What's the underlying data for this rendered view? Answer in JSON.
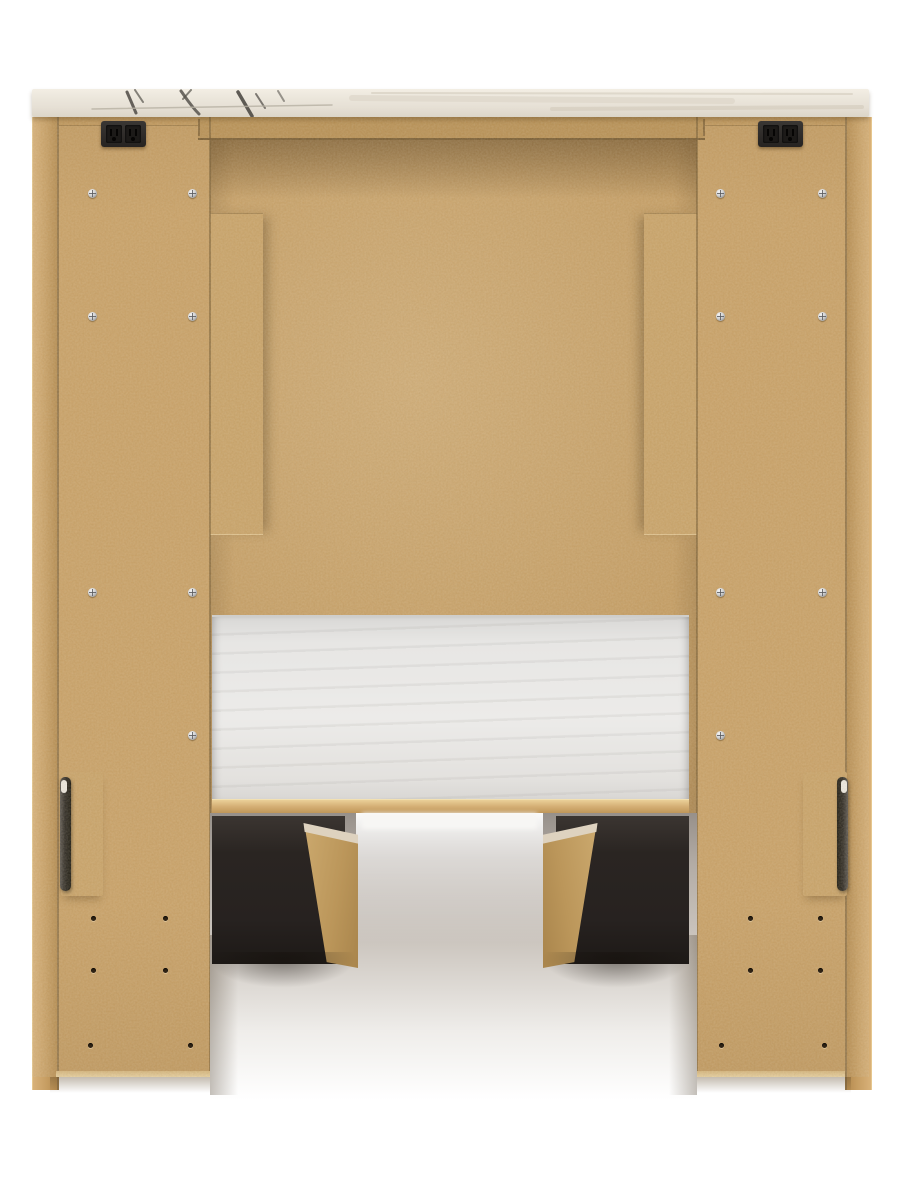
{
  "scene": {
    "description": "Back view product photo of a tan MDF platform bed / headboard unit with marble-look top panel, white fabric mattress deck, two dark under-bed storage drawers, dual built-in power outlet blocks and black mounting brackets",
    "canvas_width": 901,
    "canvas_height": 1200
  },
  "colors": {
    "page_bg": "#ffffff",
    "mdf": "#c9a065",
    "mdf_back": "#c49b60",
    "mdf_board": "#c9a267",
    "rail_a": "#c0965a",
    "rail_b": "#b78e52",
    "marble_base": "#e9e3d8",
    "deck_white": "#ecebe9",
    "wood_edge": "#ded2bf",
    "drawer_black": "#2a2522",
    "hole": "#2e2214",
    "glow": "#f7f6f4",
    "bracket_dark": "#26231f",
    "screw_metal": "#d2d3d4"
  },
  "hardware": {
    "outlets": [
      {
        "x": 101,
        "y": 121
      },
      {
        "x": 758,
        "y": 121
      }
    ],
    "screws": [
      [
        88,
        189
      ],
      [
        188,
        189
      ],
      [
        88,
        312
      ],
      [
        188,
        312
      ],
      [
        88,
        588
      ],
      [
        188,
        588
      ],
      [
        188,
        731
      ],
      [
        716,
        189
      ],
      [
        818,
        189
      ],
      [
        716,
        312
      ],
      [
        818,
        312
      ],
      [
        716,
        588
      ],
      [
        818,
        588
      ],
      [
        716,
        731
      ]
    ],
    "holes": [
      [
        91,
        916
      ],
      [
        163,
        916
      ],
      [
        91,
        968
      ],
      [
        163,
        968
      ],
      [
        88,
        1043
      ],
      [
        188,
        1043
      ],
      [
        748,
        916
      ],
      [
        818,
        916
      ],
      [
        748,
        968
      ],
      [
        818,
        968
      ],
      [
        719,
        1043
      ],
      [
        822,
        1043
      ]
    ]
  },
  "marble_veins": [
    {
      "d": "M95 3 L104 24",
      "w": 3,
      "c": "#56524c",
      "o": 0.9
    },
    {
      "d": "M103 1 L111 13",
      "w": 2,
      "c": "#56524c",
      "o": 0.7
    },
    {
      "d": "M149 2 C154 9 159 17 167 25",
      "w": 3,
      "c": "#56524c",
      "o": 0.85
    },
    {
      "d": "M159 1 L151 10",
      "w": 2,
      "c": "#56524c",
      "o": 0.7
    },
    {
      "d": "M206 3 L220 27",
      "w": 3.5,
      "c": "#4e4a45",
      "o": 0.9
    },
    {
      "d": "M224 5 L233 19",
      "w": 2,
      "c": "#56524c",
      "o": 0.75
    },
    {
      "d": "M246 2 L252 12",
      "w": 2,
      "c": "#5c5851",
      "o": 0.6
    },
    {
      "d": "M60 20 L300 16",
      "w": 1.5,
      "c": "#b7b0a2",
      "o": 0.8
    },
    {
      "d": "M320 9 L700 12",
      "w": 6,
      "c": "#ddd6c9",
      "o": 0.7
    },
    {
      "d": "M520 20 L830 18",
      "w": 4,
      "c": "#d2cabb",
      "o": 0.6
    },
    {
      "d": "M340 4 L820 5",
      "w": 2,
      "c": "#cdc5b5",
      "o": 0.5
    }
  ]
}
